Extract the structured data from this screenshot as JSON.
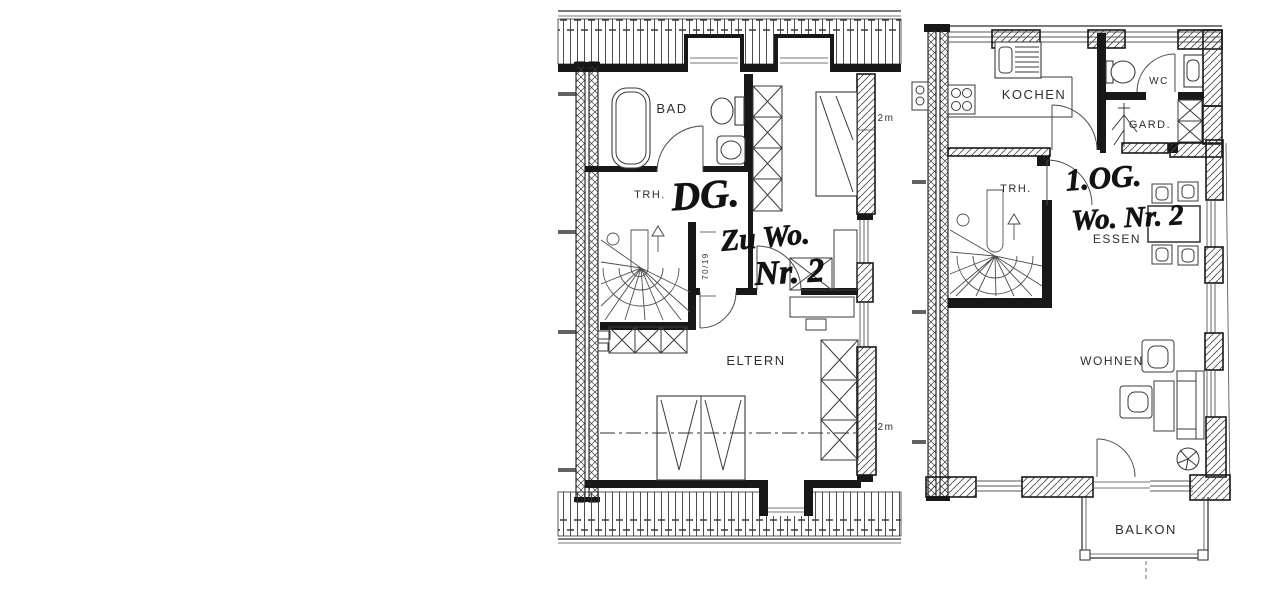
{
  "page": {
    "background_color": "#ffffff",
    "ink_color": "#1a1a1a",
    "description": "Two hand-annotated apartment floor plans"
  },
  "dg_plan": {
    "handwritten": {
      "line1": "DG.",
      "line2": "Zu Wo.",
      "line3": "Nr. 2"
    },
    "rooms": {
      "bad": "BAD",
      "trh": "TRH.",
      "eltern": "ELTERN"
    },
    "markers": {
      "top": "2m",
      "bottom": "2m",
      "door": "70/19"
    }
  },
  "og_plan": {
    "handwritten": {
      "line1": "1.OG.",
      "line2": "Wo. Nr. 2"
    },
    "rooms": {
      "kochen": "KOCHEN",
      "wc": "WC",
      "gard": "GARD.",
      "trh": "TRH.",
      "essen": "ESSEN",
      "wohnen": "WOHNEN",
      "balkon": "BALKON"
    }
  }
}
